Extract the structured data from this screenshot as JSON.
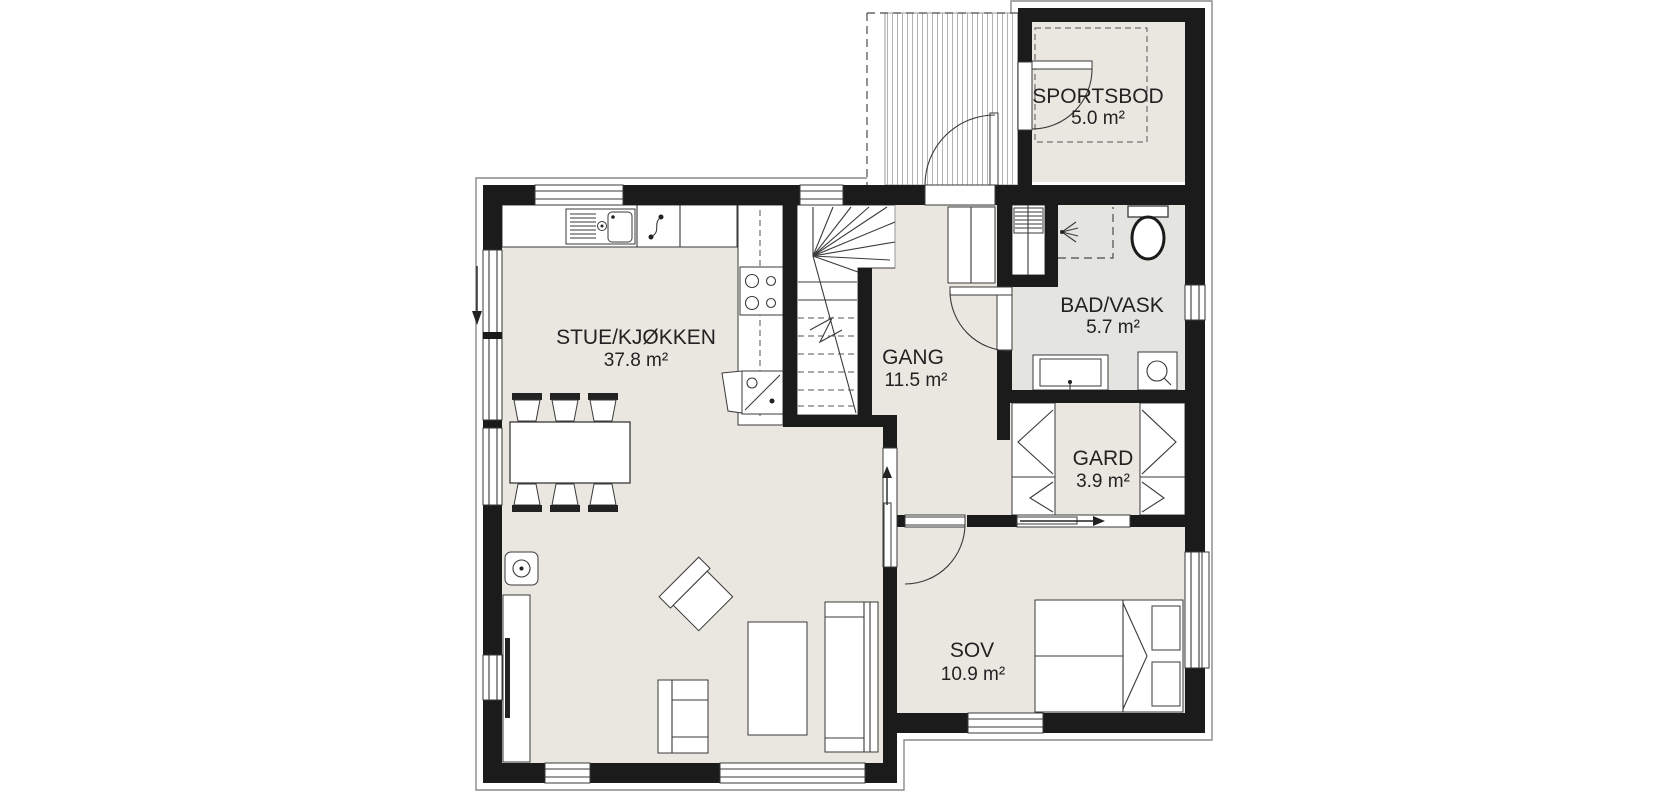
{
  "plan": {
    "type": "floorplan",
    "rooms": [
      {
        "name": "SPORTSBOD",
        "area": "5.0 m²"
      },
      {
        "name": "STUE/KJØKKEN",
        "area": "37.8 m²"
      },
      {
        "name": "GANG",
        "area": "11.5 m²"
      },
      {
        "name": "BAD/VASK",
        "area": "5.7 m²"
      },
      {
        "name": "GARD",
        "area": "3.9 m²"
      },
      {
        "name": "SOV",
        "area": "10.9 m²"
      }
    ],
    "colors": {
      "wall": "#1b1b1b",
      "floor": "#e9e7e0",
      "floor_bath": "#e4e4e1",
      "hatch": "#b3b3b3",
      "outline": "#8a8a8a",
      "text": "#222222"
    }
  }
}
